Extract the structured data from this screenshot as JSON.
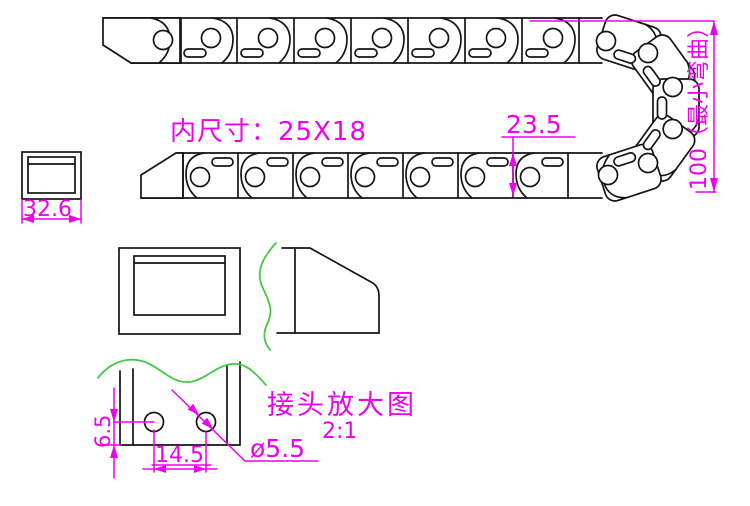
{
  "drawing": {
    "background": "#ffffff",
    "colors": {
      "outline": "#141414",
      "dimension": "#ee00ee",
      "break_line": "#46c846"
    },
    "labels": {
      "inner_size": "内尺寸：25X18",
      "chain_height": "23.5",
      "min_bend": "100（最小弯曲）",
      "end_width": "32.6",
      "hole_edge_distance": "6.5",
      "hole_spacing": "14.5",
      "hole_diameter": "ø5.5",
      "detail_title": "接头放大图",
      "detail_scale": "2:1"
    }
  }
}
